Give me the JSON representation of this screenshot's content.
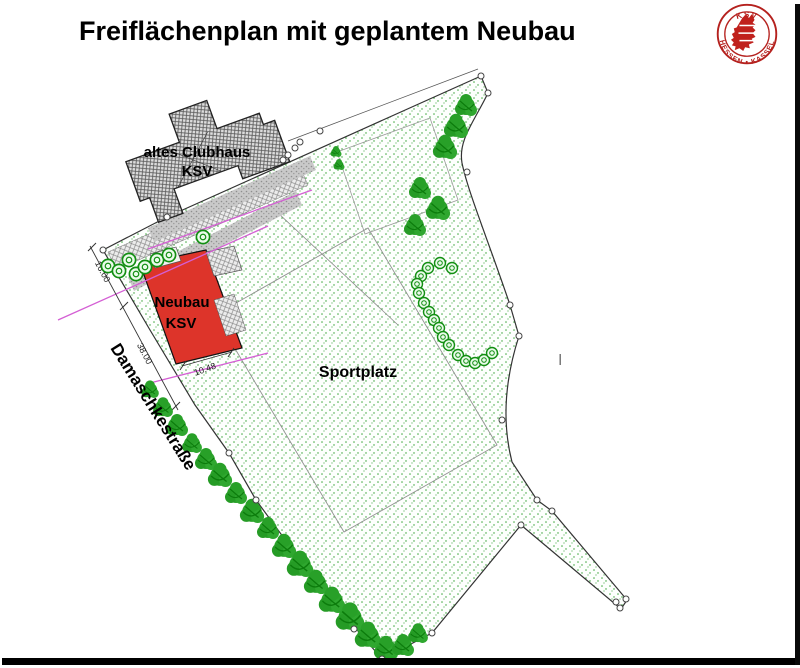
{
  "title": "Freiflächenplan mit geplantem Neubau",
  "logo": {
    "club": "KSV Hessen Kassel",
    "top_text": "KSV",
    "bottom_text": "HESSEN • KASSEL"
  },
  "plan": {
    "old_clubhouse": {
      "line1": "altes Clubhaus",
      "line2": "KSV"
    },
    "new_building": {
      "line1": "Neubau",
      "line2": "KSV"
    },
    "sports_field_label": "Sportplatz",
    "street_label": "Damaschkestraße",
    "cursor_artifact": "I",
    "dimensions": {
      "d1": "16.00",
      "d2": "38.00",
      "d3": "10.48"
    }
  },
  "colors": {
    "new_building_fill": "#dd342a",
    "grass_dot": "#33a333",
    "tree_green": "#2ba32b",
    "hedge_green": "#128f12",
    "survey_line": "#d45fd4",
    "outline": "#333333",
    "logo_red": "#b5211e"
  }
}
